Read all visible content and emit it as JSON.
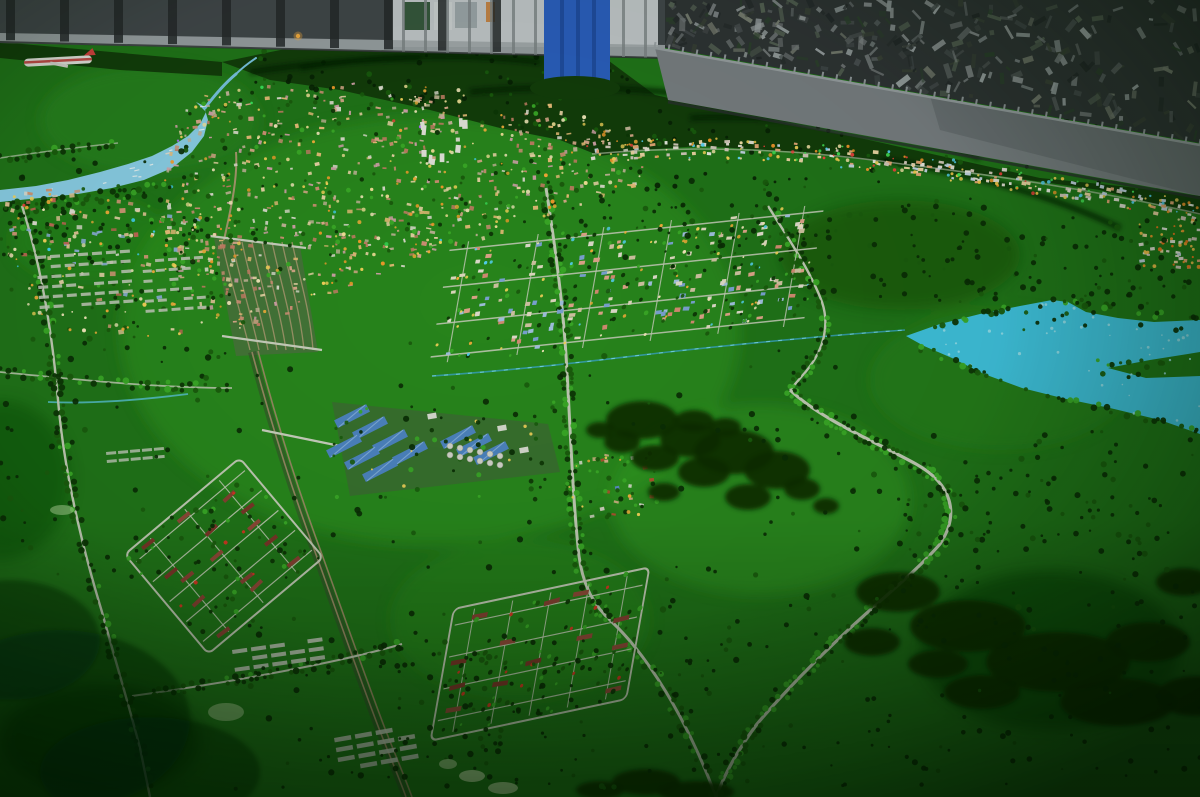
{
  "scene": {
    "label": "Photograph of an illuminated urban planning scale model city with green terrain, river, lake, roads and housing estates, displayed in an exhibition room",
    "width": 1200,
    "height": 797,
    "seed": 20240613,
    "palette": {
      "field": "#21761a",
      "hill": "#123c0b",
      "ridge": "#071f04",
      "forest": "#0a2b05",
      "treeDark": "#0d3506",
      "treeMid": "#1a5c0e",
      "treeBright": "#3cae29",
      "road": "#c8cfbc",
      "water": "#41c7e7",
      "waterLight": "#a8e8f6",
      "river": "#8fd4f0",
      "rail": "#ab9a72",
      "railBed": "#39452f",
      "wall": "#42464c",
      "rib": "#24272c",
      "skirt": "#a3a8ae",
      "panel": "#c6cacf",
      "tarp": "#2b5fc4",
      "tarpFold": "#1d4498",
      "band": "#7b7f86",
      "bandHi": "#9ba0a6",
      "pile": "#2f3236",
      "houseRed": "#7d352a",
      "accentRed": "#e03424",
      "blueRoof": "#4f86c8",
      "blueRidge": "#8ab4e4",
      "tank": "#d9d9d2",
      "plane": "#e8e6e2",
      "planeStripe": "#c03030",
      "pond": "#cde8b4",
      "glowOrange": "#ffb040"
    },
    "wall": {
      "poly": "0,0 665,0 665,58 0,42",
      "ribFrom": 6,
      "ribTo": 652,
      "ribStep": 54,
      "ribW": 9,
      "panel": [
        392,
        0,
        266,
        47
      ],
      "panelSlatStep": 22,
      "posters": [
        [
          404,
          2,
          26,
          28,
          "#274a2e"
        ],
        [
          434,
          2,
          18,
          28,
          "#cfd3d6"
        ],
        [
          455,
          2,
          22,
          26,
          "#9aa3a8"
        ],
        [
          486,
          2,
          9,
          20,
          "#c87d3a"
        ]
      ],
      "skirt": "0,33 665,45 665,58 0,43",
      "tarp": [
        544,
        0,
        66,
        86
      ],
      "tarpBump": [
        575,
        88,
        45,
        12
      ]
    },
    "pile": {
      "poly": "655,0 1200,0 1200,143 655,46",
      "n": 300,
      "colors": [
        "#565a5e",
        "#6e7276",
        "#8b8f93",
        "#44484c",
        "#23262a",
        "#3a4038",
        "#556055",
        "#9aa0a4",
        "#2c3e2e",
        "#777b72"
      ]
    },
    "band": {
      "poly": "655,48 1200,145 1200,196 668,100",
      "darkHalf": "930,96 1200,145 1200,196 940,130",
      "top": [
        655,
        48,
        1200,
        145
      ],
      "ticks": 40,
      "shadow": [
        668,
        102,
        1200,
        198
      ]
    },
    "hills": {
      "polys": [
        "222,62 300,46 380,40 470,42 548,50 605,58 655,95 760,118 860,138 950,158 1040,178 1120,186 1200,196 1200,215 1100,190 1000,176 900,164 800,152 700,146 640,150 600,156 560,140 500,128 430,110 340,90 270,80",
        "0,42 222,62 222,76 120,70 0,58"
      ],
      "ridges": [
        "M300,68 Q420,48 540,62",
        "M470,92 Q620,78 760,106",
        "M690,118 Q850,112 980,158",
        "M880,160 Q1020,180 1120,228",
        "M250,72 Q330,60 420,58"
      ],
      "scatter": [
        [
          230,
          44,
          420,
          62,
          70
        ],
        [
          650,
          95,
          550,
          95,
          95
        ]
      ]
    },
    "field_patches": [
      [
        430,
        330,
        620,
        430,
        "#2f9c20",
        0.5
      ],
      [
        760,
        500,
        300,
        190,
        "#36a826",
        0.38
      ],
      [
        150,
        120,
        220,
        110,
        "#2c8f1e",
        0.45
      ],
      [
        520,
        620,
        260,
        160,
        "#2f9c20",
        0.3
      ],
      [
        90,
        240,
        160,
        90,
        "#2f9c20",
        0.35
      ],
      [
        1000,
        380,
        260,
        140,
        "#2c8f1e",
        0.3
      ],
      [
        1050,
        650,
        260,
        160,
        "#0c3a08",
        0.5
      ],
      [
        100,
        740,
        200,
        110,
        "#083008",
        0.55
      ],
      [
        900,
        255,
        240,
        110,
        "#11470c",
        0.45
      ],
      [
        0,
        480,
        140,
        160,
        "#0e4409",
        0.4
      ]
    ],
    "river": {
      "poly": "196,102 206,112 200,124 188,136 172,146 152,156 128,164 100,172 68,180 36,186 0,190 0,202 40,198 78,194 112,188 144,180 172,168 192,152 204,136 208,120 204,106",
      "upstream": [
        "M205,108 C214,96 224,84 236,74",
        "M236,74 C243,67 250,62 256,58"
      ],
      "glints": 10,
      "bank": {
        "d": "M6,200 Q90,194 160,178",
        "n": 42
      }
    },
    "streams": [
      {
        "d": "M432,376 C520,370 600,360 668,352 C740,344 820,336 905,330",
        "c": "#3aa8cc",
        "w": 1.6,
        "o": 0.8,
        "dash": true
      },
      {
        "d": "M48,402 C90,404 140,400 188,394",
        "c": "#5bc8e0",
        "w": 1.8,
        "o": 0.8,
        "dash": false
      }
    ],
    "lake": {
      "poly": "906,336 940,324 980,314 1020,306 1052,300 1068,302 1086,312 1118,318 1154,322 1200,320 1200,434 1160,420 1110,408 1062,398 1022,388 984,374 952,358 924,346",
      "notch": "1200,352 1150,360 1108,368 1146,378 1200,376",
      "speckles": 45,
      "shoreTop": {
        "d": "M906,334 Q1000,306 1068,300 Q1130,314 1200,318",
        "n": 30
      },
      "shoreBottom": {
        "d": "M920,348 Q1000,382 1070,400 Q1140,416 1200,432",
        "n": 34
      },
      "peninsula": [
        1095,
        360,
        70,
        18,
        12
      ]
    },
    "roads": [
      {
        "d": "M22,206 C40,262 52,330 58,400 C64,472 82,546 102,612 C114,656 128,702 140,748 L150,797",
        "w": 2.4,
        "step": 7,
        "jit": 3,
        "bright": 0.18
      },
      {
        "d": "M132,696 C190,688 250,678 310,666 C345,659 375,652 402,644",
        "w": 2,
        "step": 7,
        "jit": 2.5,
        "bright": 0.15
      },
      {
        "d": "M546,188 C556,252 564,312 567,372 C571,442 573,502 579,556 C583,586 594,606 612,622 C646,654 686,716 716,797",
        "w": 3,
        "step": 5.5,
        "jit": 3.2,
        "bright": 0.3
      },
      {
        "d": "M790,390 C822,420 872,440 916,464 C952,484 960,514 940,544 C916,572 880,600 846,632 C816,660 786,690 757,724 C740,747 726,770 716,797",
        "w": 3.2,
        "step": 5,
        "jit": 2.8,
        "bright": 0.5
      },
      {
        "d": "M768,206 C788,238 810,270 822,302 C830,326 824,352 802,376 L790,390",
        "w": 2.4,
        "step": 6,
        "jit": 2.6,
        "bright": 0.3
      },
      {
        "d": "M0,372 C80,380 160,388 232,388",
        "w": 1.8,
        "o": 0.85,
        "step": 8,
        "jit": 2.5,
        "bright": 0.2
      },
      {
        "d": "M0,158 C40,152 80,147 118,143",
        "w": 1.4,
        "o": 0.7,
        "step": 8,
        "jit": 2,
        "bright": 0.15
      }
    ],
    "railway": {
      "yardGround": "214,238 300,246 318,352 236,356",
      "yard": {
        "x0": 222,
        "dx": 10,
        "n": 8
      },
      "entry": "M236,152 C238,180 230,212 224,240",
      "main": [
        "M252,352 C270,420 292,490 318,560 C336,610 356,668 378,726 C388,752 398,775 406,797",
        "M258,351 C276,420 298,490 324,560 C342,610 362,668 384,726 C394,752 404,775 412,797"
      ],
      "overpasses": [
        "M210,236 L306,248",
        "M222,336 L322,350",
        "M262,430 L340,446"
      ]
    },
    "regions": [
      {
        "name": "west-suburb-buildings",
        "poly": "6,196 70,186 140,200 205,222 232,244 232,302 204,332 150,342 88,336 28,318 6,290",
        "n": 150,
        "smin": 3,
        "smax": 6,
        "colors": [
          "#d79a7a",
          "#e8c89a",
          "#8fb2e0",
          "#e8e4da",
          "#c86858",
          "#f0d8b0"
        ],
        "treeN": 60,
        "lightN": 70,
        "lights": [
          "#ffd95e",
          "#ffb23e",
          "#fff0c4"
        ],
        "rare": [
          "#45d8ff",
          "#ff4040"
        ],
        "rareP": 0.06,
        "topBias": 268
      },
      {
        "name": "city-core-buildings",
        "poly": "192,98 280,82 380,84 470,90 560,104 626,122 664,150 648,182 600,205 540,222 470,243 400,268 340,292 290,315 244,330 210,322 182,290 165,240 162,182 172,132",
        "n": 520,
        "smin": 2,
        "smax": 5.5,
        "colors": [
          "#d7937a",
          "#e6ae93",
          "#f1d9ac",
          "#e7e3d9",
          "#c9b89e",
          "#f3c27e",
          "#dba5b2",
          "#c87f68"
        ],
        "treeN": 150,
        "lightN": 230,
        "lights": [
          "#ffd95e",
          "#ffb23e",
          "#fff0c4",
          "#ffa02e",
          "#ffe9a0"
        ],
        "rare": [
          "#45d8ff",
          "#3ae85e",
          "#ff4040",
          "#b070ff"
        ],
        "rareP": 0.08
      },
      {
        "name": "village-cluster",
        "poly": "566,458 652,452 658,512 590,524 566,500",
        "n": 18,
        "smin": 3,
        "smax": 5,
        "colors": [
          "#e8e6de",
          "#c84a34",
          "#5f8fd8",
          "#d8d4c8",
          "#e0b890"
        ],
        "treeN": 26,
        "lightN": 10,
        "lights": [
          "#ffd95e",
          "#ffb23e"
        ],
        "rare": [],
        "rareP": 0
      }
    ],
    "towers": {
      "x": 415,
      "y": 122,
      "w": 55,
      "h": 42,
      "n": 9,
      "c": "#eceae4"
    },
    "grids": [
      {
        "kind": "strips",
        "name": "greenhouse-plots-a",
        "tx": 36,
        "ty": 256,
        "rot": -4,
        "rows": 6,
        "cols": 7,
        "dx": 14,
        "dy": 10,
        "w": 10,
        "h": 3.2,
        "c": "#ccd0c6",
        "o": 0.85,
        "skip": 0.25
      },
      {
        "kind": "strips",
        "name": "greenhouse-plots-b",
        "tx": 142,
        "ty": 260,
        "rot": -4,
        "rows": 6,
        "cols": 5,
        "dx": 13,
        "dy": 10,
        "w": 9,
        "h": 3,
        "c": "#ccd0c6",
        "o": 0.85,
        "skip": 0.25
      },
      {
        "kind": "strips",
        "name": "farm-strips-a",
        "tx": 232,
        "ty": 650,
        "rot": -8,
        "rows": 3,
        "cols": 5,
        "dx": 19,
        "dy": 9,
        "w": 15,
        "h": 4,
        "c": "#c9cec2",
        "o": 0.9,
        "skip": 0.15
      },
      {
        "kind": "strips",
        "name": "farm-strips-b",
        "tx": 334,
        "ty": 738,
        "rot": -10,
        "rows": 4,
        "cols": 4,
        "dx": 21,
        "dy": 10,
        "w": 17,
        "h": 4.5,
        "c": "#c9cec2",
        "o": 0.9,
        "skip": 0.12
      },
      {
        "kind": "strips",
        "name": "farm-strips-c",
        "tx": 106,
        "ty": 452,
        "rot": -5,
        "rows": 2,
        "cols": 5,
        "dx": 12,
        "dy": 8,
        "w": 10,
        "h": 3,
        "c": "#c9cec2",
        "o": 0.8,
        "skip": 0.2
      },
      {
        "kind": "estate",
        "name": "south-housing-estate",
        "tx": 540,
        "ty": 654,
        "rot": -12,
        "skew": -22,
        "w": 200,
        "h": 124,
        "rowYs": [
          -46,
          -16,
          14,
          44
        ],
        "colXs": [
          -78,
          -39,
          0,
          39,
          78
        ],
        "houseW": 16,
        "houseH": 4.5,
        "colors": [
          "#7d352a",
          "#8a4034",
          "#93483a"
        ],
        "accentN": 12,
        "treeN": 70
      },
      {
        "kind": "estate",
        "name": "west-housing-estate",
        "tx": 224,
        "ty": 556,
        "rot": -40,
        "skew": 0,
        "w": 150,
        "h": 130,
        "rowYs": [
          -52,
          -26,
          0,
          26,
          52
        ],
        "colXs": [
          -45,
          0,
          45
        ],
        "houseW": 15,
        "houseH": 4,
        "colors": [
          "#7d352a",
          "#8a4034",
          "#93483a"
        ],
        "accentN": 6,
        "treeN": 55
      },
      {
        "kind": "suburb",
        "name": "southeast-suburb-grid",
        "tx": 627,
        "ty": 284,
        "rot": -6,
        "skew": -16,
        "w": 376,
        "h": 118,
        "rowYs": [
          -52,
          -16,
          20,
          52
        ],
        "colXs": [
          -170,
          -100,
          -34,
          34,
          102,
          168
        ],
        "n": 150,
        "smin": 3.5,
        "smax": 6.5,
        "colors": [
          "#dd8f78",
          "#7fa7dc",
          "#e9e3d5",
          "#d9c9a9",
          "#a7c6ea",
          "#e8a890",
          "#e8e0c8"
        ],
        "treeN": 95,
        "lightN": 70,
        "lights": [
          "#ffd95e",
          "#ffb23e",
          "#fff0c4",
          "#58d8ff"
        ]
      }
    ],
    "industrial": {
      "ground": "332,402 548,424 560,472 350,496",
      "sheds": [
        [
          352,
          416
        ],
        [
          370,
          428
        ],
        [
          390,
          441
        ],
        [
          410,
          453
        ],
        [
          344,
          446
        ],
        [
          362,
          458
        ],
        [
          458,
          437
        ],
        [
          474,
          445
        ],
        [
          491,
          453
        ],
        [
          380,
          470
        ]
      ],
      "shedW": 36,
      "shedH": 8.5,
      "rot": -27,
      "tanks": {
        "x": 450,
        "y": 446,
        "cols": 6,
        "dx": 10,
        "rows": 2,
        "dy": 9,
        "slope": 2,
        "r": 3
      },
      "white": [
        [
          432,
          416
        ],
        [
          502,
          428
        ],
        [
          524,
          450
        ]
      ],
      "lightN": 8,
      "treeN": 40
    },
    "ribbon": {
      "d": "M592,154 C700,144 806,150 902,164 C1002,176 1104,192 1200,214",
      "roadW": 1.6,
      "n": 140,
      "jit": 9,
      "smin": 2.5,
      "smax": 6,
      "colors": [
        "#e8e4da",
        "#f2d9a8",
        "#d8ccc0",
        "#c8d8ea",
        "#e8a878",
        "#f0f0e8"
      ],
      "lightN": 150,
      "lightJit": 11,
      "lightColors": [
        "#ffcf4e",
        "#ff9a2e",
        "#ffe9b0",
        "#58d8ff",
        "#45e858",
        "#ff4040",
        "#ffd95e"
      ],
      "extra": {
        "rect": [
          1138,
          224,
          62,
          44
        ],
        "n": 26,
        "lightN": 30,
        "lights": [
          "#ff9a2e",
          "#ff7a20",
          "#ffc44e"
        ]
      }
    },
    "forests": [
      [
        [
          642,
          420,
          36,
          19
        ],
        [
          690,
          440,
          30,
          17
        ],
        [
          734,
          452,
          40,
          22
        ],
        [
          777,
          470,
          33,
          19
        ],
        [
          704,
          472,
          26,
          15
        ],
        [
          655,
          458,
          24,
          13
        ],
        [
          622,
          442,
          18,
          11
        ],
        [
          748,
          497,
          23,
          13
        ],
        [
          802,
          489,
          18,
          11
        ],
        [
          694,
          421,
          20,
          11
        ],
        [
          664,
          492,
          16,
          9
        ],
        [
          725,
          427,
          16,
          9
        ],
        [
          826,
          506,
          13,
          8
        ],
        [
          600,
          430,
          14,
          8
        ]
      ],
      [
        [
          898,
          592,
          42,
          20
        ],
        [
          968,
          626,
          58,
          26
        ],
        [
          1058,
          662,
          72,
          30
        ],
        [
          1148,
          642,
          42,
          20
        ],
        [
          1118,
          702,
          58,
          24
        ],
        [
          982,
          692,
          38,
          17
        ],
        [
          872,
          642,
          28,
          14
        ],
        [
          1184,
          582,
          28,
          14
        ],
        [
          1196,
          696,
          40,
          20
        ],
        [
          938,
          664,
          30,
          14
        ]
      ],
      [
        [
          646,
          782,
          34,
          13
        ],
        [
          696,
          792,
          38,
          11
        ],
        [
          600,
          790,
          24,
          9
        ]
      ]
    ],
    "darkCorners": [
      [
        60,
        720,
        130,
        90,
        0.5
      ],
      [
        10,
        640,
        90,
        60,
        0.45
      ],
      [
        150,
        772,
        110,
        55,
        0.5
      ]
    ],
    "scatter": [
      [
        560,
        180,
        220,
        95,
        55
      ],
      [
        780,
        192,
        220,
        110,
        75
      ],
      [
        1000,
        215,
        200,
        118,
        75
      ],
      [
        830,
        430,
        370,
        125,
        65
      ],
      [
        320,
        335,
        540,
        240,
        65
      ],
      [
        640,
        565,
        560,
        225,
        160
      ],
      [
        235,
        600,
        380,
        190,
        75
      ],
      [
        0,
        330,
        300,
        260,
        65
      ],
      [
        0,
        150,
        230,
        115,
        50
      ],
      [
        900,
        470,
        300,
        90,
        50
      ],
      [
        360,
        640,
        260,
        150,
        55
      ]
    ],
    "ponds": [
      [
        472,
        776,
        13,
        6,
        0.75
      ],
      [
        503,
        788,
        15,
        6,
        0.75
      ],
      [
        226,
        712,
        18,
        9,
        0.5
      ],
      [
        62,
        510,
        12,
        5,
        0.45
      ],
      [
        448,
        764,
        9,
        5,
        0.6
      ]
    ],
    "airplane": {
      "tx": 58,
      "ty": 61,
      "rot": -3
    },
    "hill_light": {
      "x": 298,
      "y": 36
    }
  }
}
